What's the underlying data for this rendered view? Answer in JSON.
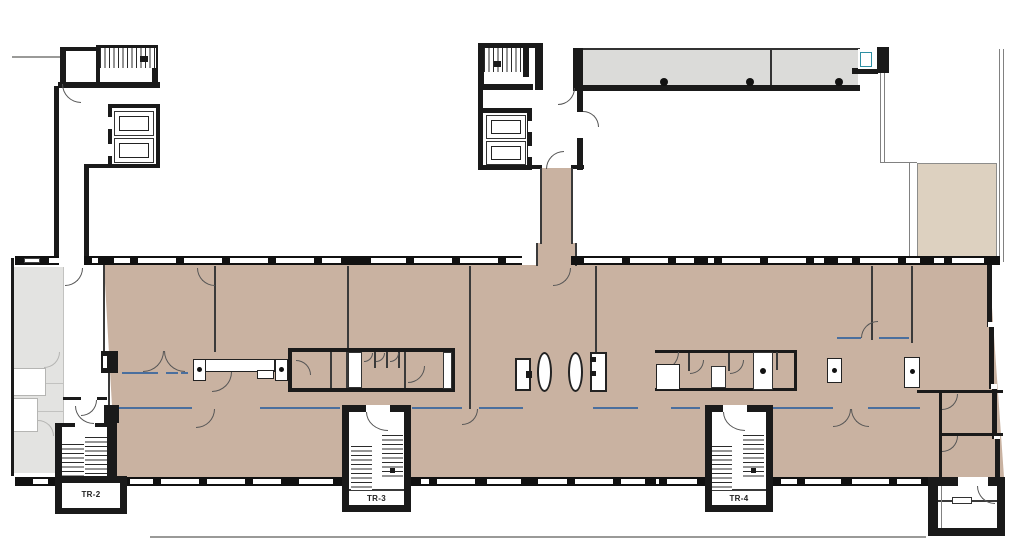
{
  "plan": {
    "type": "architectural-floor-plan",
    "labels": {
      "tr2": "TR-2",
      "tr3": "TR-3",
      "tr4": "TR-4"
    },
    "colors": {
      "floor_fill_tan": "#c9b2a1",
      "roof_terrace_gray": "#dbdbd9",
      "adjacent_building_gray": "#e3e3e1",
      "terrace_light_tan": "#ddd1c0",
      "wall_black": "#1a1a1a",
      "glass_partition_blue": "#4a6f9e",
      "fixture_teal": "#2e8fa3"
    }
  }
}
